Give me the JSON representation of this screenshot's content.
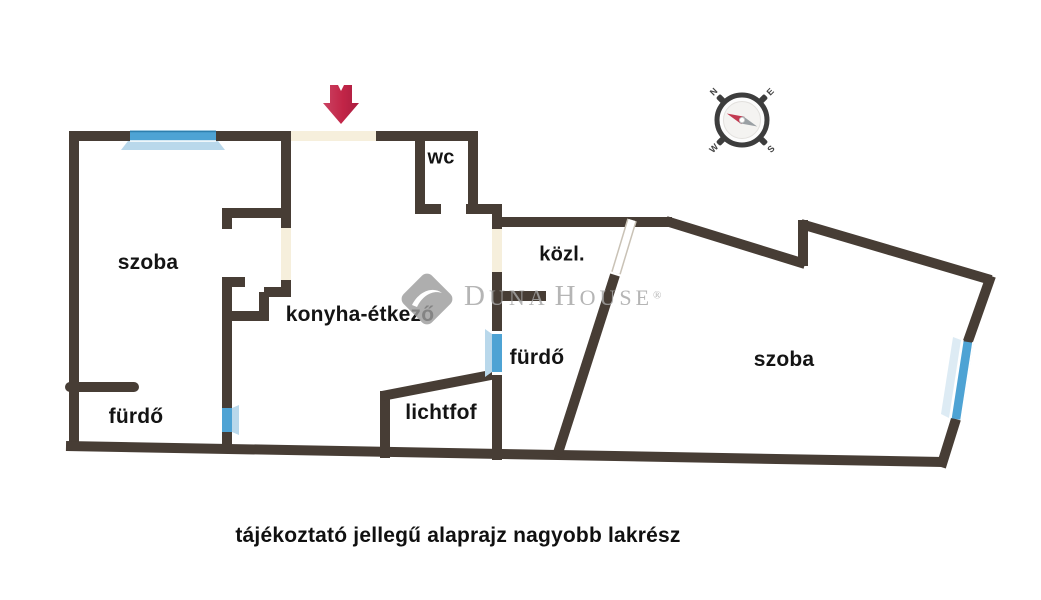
{
  "plan": {
    "rooms": {
      "szoba_left": {
        "label": "szoba"
      },
      "wc": {
        "label": "wc"
      },
      "kozl": {
        "label": "közl."
      },
      "konyha": {
        "label": "konyha-étkező"
      },
      "furdo_left": {
        "label": "fürdő"
      },
      "furdo_mid": {
        "label": "fürdő"
      },
      "lichtfof": {
        "label": "lichtfof"
      },
      "szoba_right": {
        "label": "szoba"
      }
    },
    "caption": "tájékoztató jellegű alaprajz nagyobb lakrész"
  },
  "watermark": {
    "full_name": "DUNA HOUSE®",
    "d": "D",
    "una": "UNA",
    "h": "H",
    "ouse": "OUSE",
    "registered": "®"
  },
  "compass": {
    "n": "N",
    "e": "E",
    "s": "S",
    "w": "W"
  },
  "icons": {
    "entrance": "entrance-arrow-icon",
    "compass": "compass-icon",
    "brand": "duna-house-logo-icon"
  },
  "colors": {
    "wall": "#473d35",
    "window_blue": "#4ea3d4",
    "window_light": "#b9d8eb",
    "door_gap": "#f6efdc",
    "entrance_arrow": "#c22547",
    "watermark_gray": "#a5a5a5",
    "label_text": "#141414",
    "background": "#ffffff"
  }
}
